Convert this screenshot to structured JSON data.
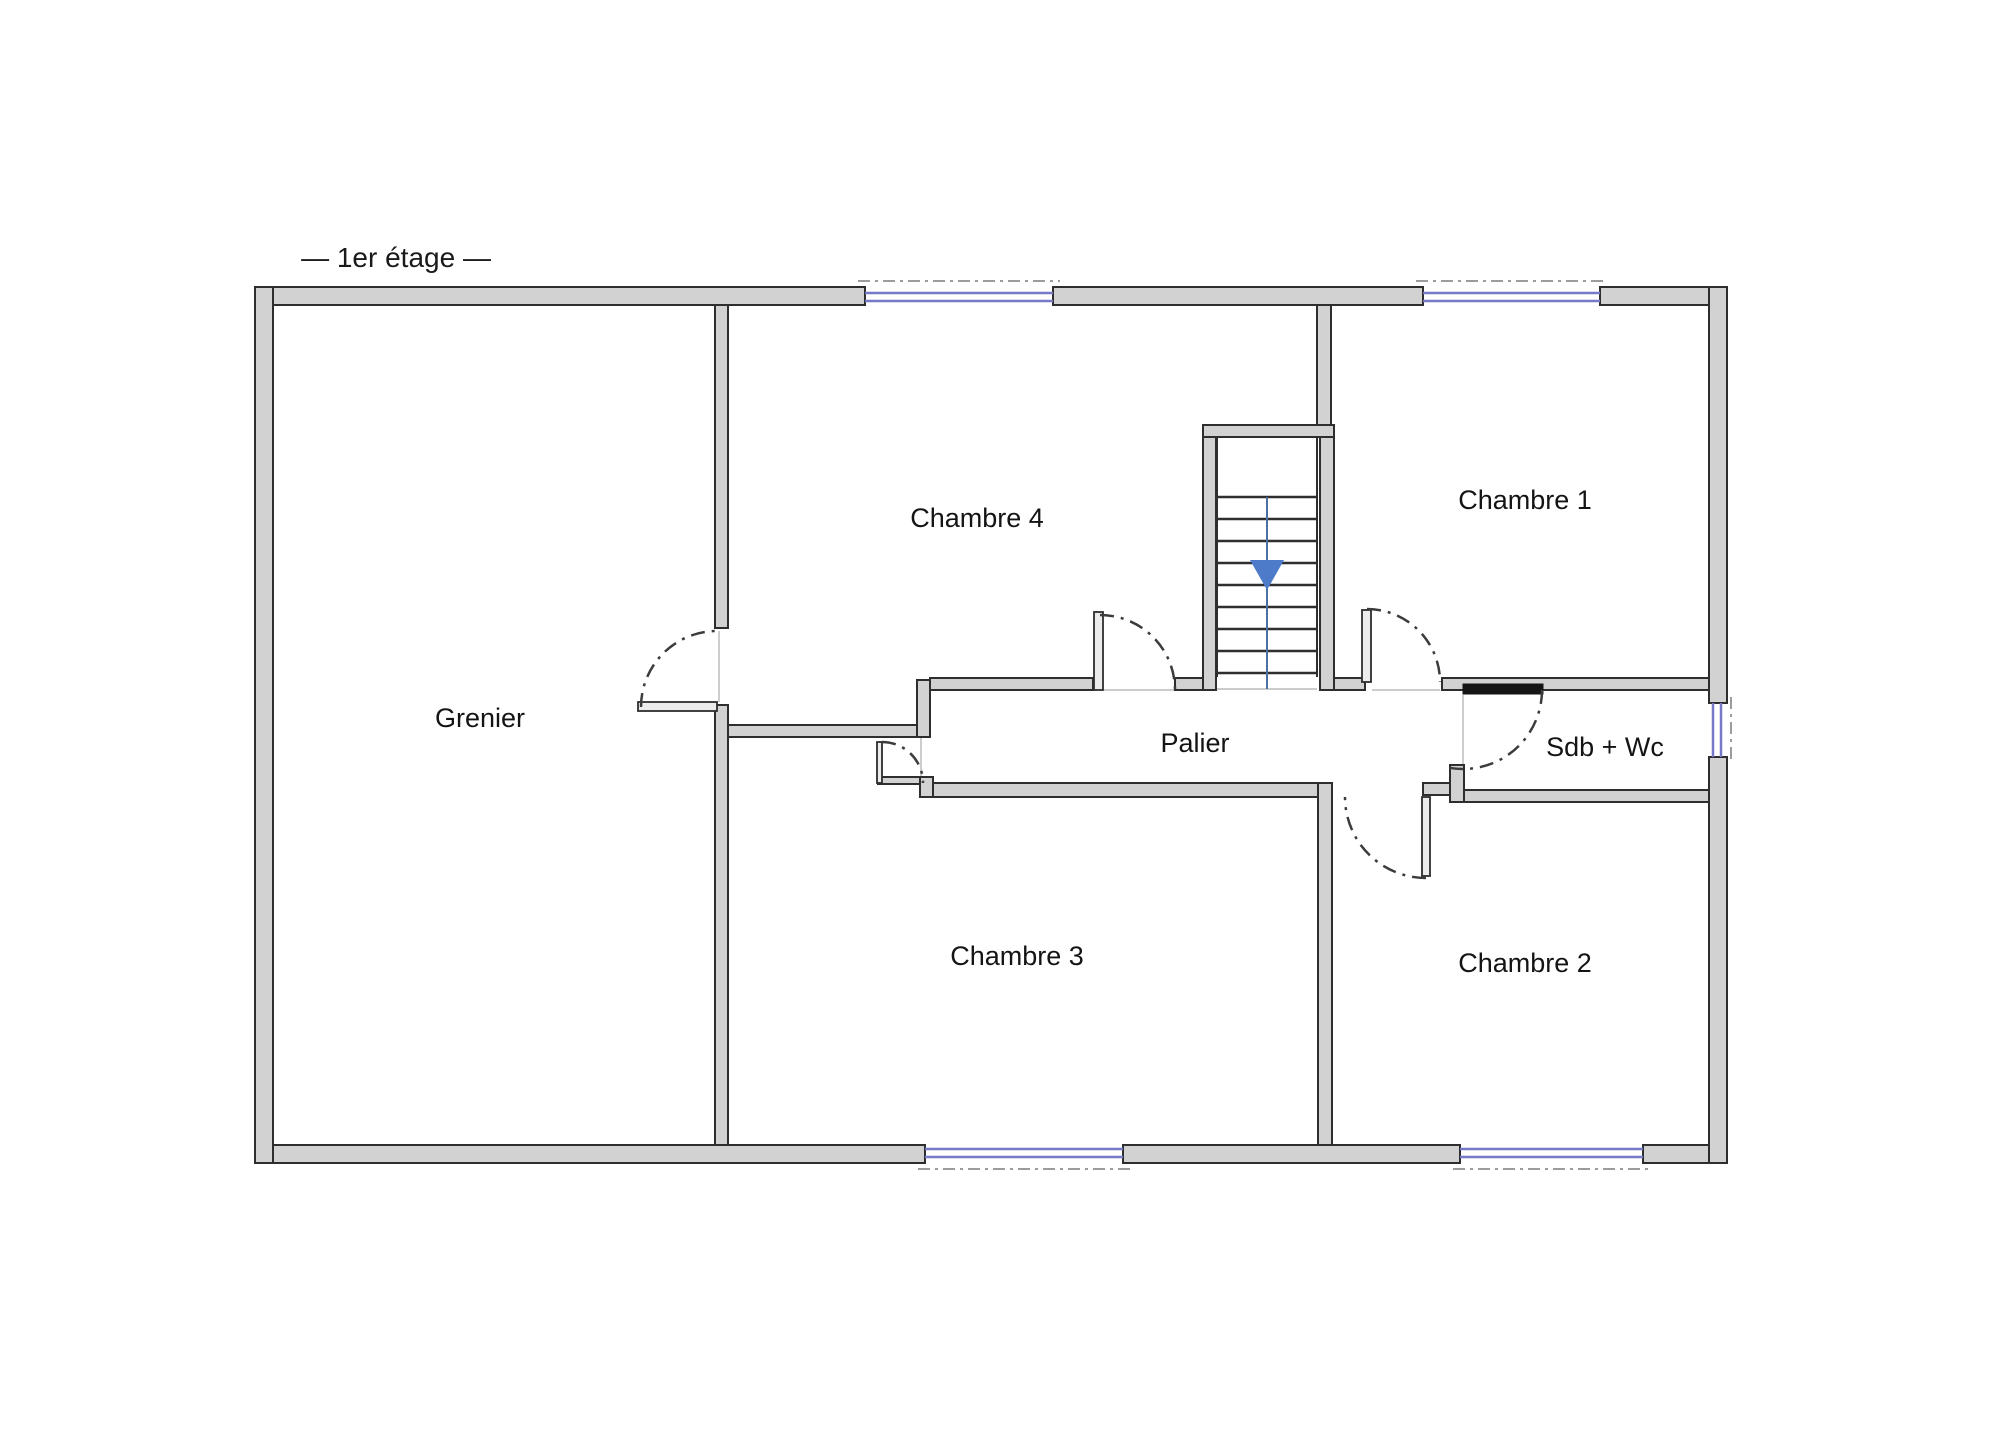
{
  "title": {
    "label": "— 1er étage —"
  },
  "rooms": [
    {
      "id": "grenier",
      "label": "Grenier"
    },
    {
      "id": "chambre4",
      "label": "Chambre 4"
    },
    {
      "id": "chambre1",
      "label": "Chambre 1"
    },
    {
      "id": "palier",
      "label": "Palier"
    },
    {
      "id": "sdb",
      "label": "Sdb + Wc"
    },
    {
      "id": "chambre3",
      "label": "Chambre 3"
    },
    {
      "id": "chambre2",
      "label": "Chambre 2"
    }
  ],
  "colors": {
    "wall_fill": "#d2d2d2",
    "wall_stroke": "#2e2e2e",
    "leaf_fill": "#ececec",
    "leaf_stroke": "#2e2e2e",
    "door_bar": "#151515",
    "window_blue": "#7678c8",
    "exterior_dash": "#9c9c9c",
    "threshold": "#bcbcbc",
    "door_arc": "#3c3c3c",
    "tread": "#2e2e2e",
    "stair_rail": "#2e2e2e",
    "stair_center_line": "#4a6fa5",
    "arrow_blue": "#4d7ac9"
  },
  "geometry": {
    "thin_lines": [
      [
        719,
        631,
        719,
        702
      ],
      [
        1103,
        690,
        1175,
        690
      ],
      [
        1372,
        690,
        1440,
        690
      ],
      [
        1463,
        695,
        1463,
        765
      ],
      [
        921,
        737,
        921,
        779
      ],
      [
        1217,
        689,
        1317,
        689
      ]
    ],
    "walls": [
      {
        "name": "exterior-top-wall-left",
        "r": [
          255,
          287,
          610,
          18
        ]
      },
      {
        "name": "exterior-top-wall-middle",
        "r": [
          1053,
          287,
          370,
          18
        ]
      },
      {
        "name": "exterior-top-wall-right",
        "r": [
          1600,
          287,
          127,
          18
        ]
      },
      {
        "name": "exterior-bottom-wall-left",
        "r": [
          255,
          1145,
          670,
          18
        ]
      },
      {
        "name": "exterior-bottom-wall-middle",
        "r": [
          1123,
          1145,
          337,
          18
        ]
      },
      {
        "name": "exterior-bottom-wall-right",
        "r": [
          1643,
          1145,
          84,
          18
        ]
      },
      {
        "name": "exterior-left-wall",
        "r": [
          255,
          287,
          18,
          876
        ]
      },
      {
        "name": "exterior-right-wall-upper",
        "r": [
          1709,
          287,
          18,
          416
        ]
      },
      {
        "name": "exterior-right-wall-lower",
        "r": [
          1709,
          757,
          18,
          406
        ]
      },
      {
        "name": "grenier-wall-upper",
        "r": [
          715,
          305,
          13,
          323
        ]
      },
      {
        "name": "grenier-wall-lower",
        "r": [
          715,
          705,
          13,
          440
        ]
      },
      {
        "name": "chambre4-bottom-left-wall",
        "r": [
          728,
          725,
          189,
          12
        ]
      },
      {
        "name": "palier-left-jog-wall",
        "r": [
          917,
          680,
          13,
          57
        ]
      },
      {
        "name": "palier-top-wall",
        "r": [
          930,
          678,
          163,
          12
        ]
      },
      {
        "name": "palier-top-wall-right",
        "r": [
          1175,
          678,
          41,
          12
        ]
      },
      {
        "name": "stairwell-left-wall",
        "r": [
          1203,
          425,
          13,
          265
        ]
      },
      {
        "name": "stairwell-top-wall",
        "r": [
          1203,
          425,
          131,
          12
        ]
      },
      {
        "name": "chambre4-chambre1-divider",
        "r": [
          1317,
          305,
          14,
          120
        ]
      },
      {
        "name": "stairwell-right-wall",
        "r": [
          1320,
          437,
          14,
          253
        ]
      },
      {
        "name": "chambre1-door-jamb-wall",
        "r": [
          1334,
          678,
          31,
          12
        ]
      },
      {
        "name": "sdb-top-wall",
        "r": [
          1442,
          678,
          267,
          12
        ]
      },
      {
        "name": "palier-bottom-stub-wall",
        "r": [
          878,
          777,
          47,
          7
        ]
      },
      {
        "name": "palier-bottom-jog-wall",
        "r": [
          920,
          777,
          13,
          20
        ]
      },
      {
        "name": "palier-bottom-wall",
        "r": [
          933,
          783,
          387,
          14
        ]
      },
      {
        "name": "chambre3-chambre2-divider",
        "r": [
          1318,
          783,
          14,
          362
        ]
      },
      {
        "name": "chambre2-top-wall-stub",
        "r": [
          1423,
          783,
          29,
          12
        ]
      },
      {
        "name": "sdb-bottom-wall",
        "r": [
          1452,
          790,
          257,
          12
        ]
      },
      {
        "name": "sdb-notch-pillar",
        "r": [
          1450,
          765,
          14,
          37
        ]
      }
    ],
    "door_leaves": [
      {
        "name": "grenier-door-leaf",
        "r": [
          638,
          702,
          79,
          9
        ]
      },
      {
        "name": "chambre4-door-leaf",
        "r": [
          1094,
          612,
          9,
          78
        ]
      },
      {
        "name": "chambre1-door-leaf",
        "r": [
          1362,
          610,
          9,
          72
        ]
      },
      {
        "name": "chambre2-door-leaf",
        "r": [
          1422,
          797,
          8,
          79
        ]
      },
      {
        "name": "chambre3-door-leaf",
        "r": [
          877,
          742,
          5,
          41
        ]
      }
    ],
    "door_bar": {
      "name": "sdb-sliding-door-bar",
      "r": [
        1463,
        684,
        80,
        10
      ]
    },
    "windows": [
      {
        "name": "chambre4-window",
        "l1": [
          865,
          293,
          1053,
          293
        ],
        "l2": [
          865,
          301,
          1053,
          301
        ],
        "dash": [
          858,
          281,
          1060,
          281
        ]
      },
      {
        "name": "chambre1-window",
        "l1": [
          1423,
          293,
          1600,
          293
        ],
        "l2": [
          1423,
          301,
          1600,
          301
        ],
        "dash": [
          1416,
          281,
          1607,
          281
        ]
      },
      {
        "name": "chambre3-window",
        "l1": [
          925,
          1149,
          1123,
          1149
        ],
        "l2": [
          925,
          1157,
          1123,
          1157
        ],
        "dash": [
          918,
          1169,
          1130,
          1169
        ]
      },
      {
        "name": "chambre2-window",
        "l1": [
          1460,
          1149,
          1643,
          1149
        ],
        "l2": [
          1460,
          1157,
          1643,
          1157
        ],
        "dash": [
          1453,
          1169,
          1650,
          1169
        ]
      },
      {
        "name": "sdb-window",
        "l1": [
          1713,
          703,
          1713,
          757
        ],
        "l2": [
          1721,
          703,
          1721,
          757
        ],
        "dash": [
          1731,
          697,
          1731,
          763
        ]
      }
    ],
    "door_arcs": [
      {
        "name": "grenier-door-swing",
        "cx": 717,
        "cy": 707,
        "r": 76,
        "start": 180,
        "end": 270
      },
      {
        "name": "chambre4-door-swing",
        "cx": 1100,
        "cy": 690,
        "r": 75,
        "start": 270,
        "end": 360
      },
      {
        "name": "chambre1-door-swing",
        "cx": 1367,
        "cy": 682,
        "r": 73,
        "start": 270,
        "end": 360
      },
      {
        "name": "sdb-door-swing",
        "cx": 1463,
        "cy": 690,
        "r": 79,
        "start": 0,
        "end": 100
      },
      {
        "name": "chambre2-door-swing",
        "cx": 1426,
        "cy": 797,
        "r": 81,
        "start": 90,
        "end": 180
      },
      {
        "name": "chambre3-door-swing",
        "cx": 882,
        "cy": 783,
        "r": 41,
        "start": 270,
        "end": 360
      }
    ],
    "stairs": {
      "rails": [
        [
          1217,
          437,
          1217,
          677
        ],
        [
          1317,
          437,
          1317,
          677
        ]
      ],
      "tread_x": [
        1217,
        1317
      ],
      "treads_y": [
        497,
        519,
        541,
        563,
        585,
        607,
        629,
        651,
        673
      ],
      "center_line": [
        1267,
        497,
        1267,
        689
      ],
      "arrow": [
        [
          1250,
          560
        ],
        [
          1284,
          560
        ],
        [
          1267,
          590
        ]
      ]
    }
  }
}
